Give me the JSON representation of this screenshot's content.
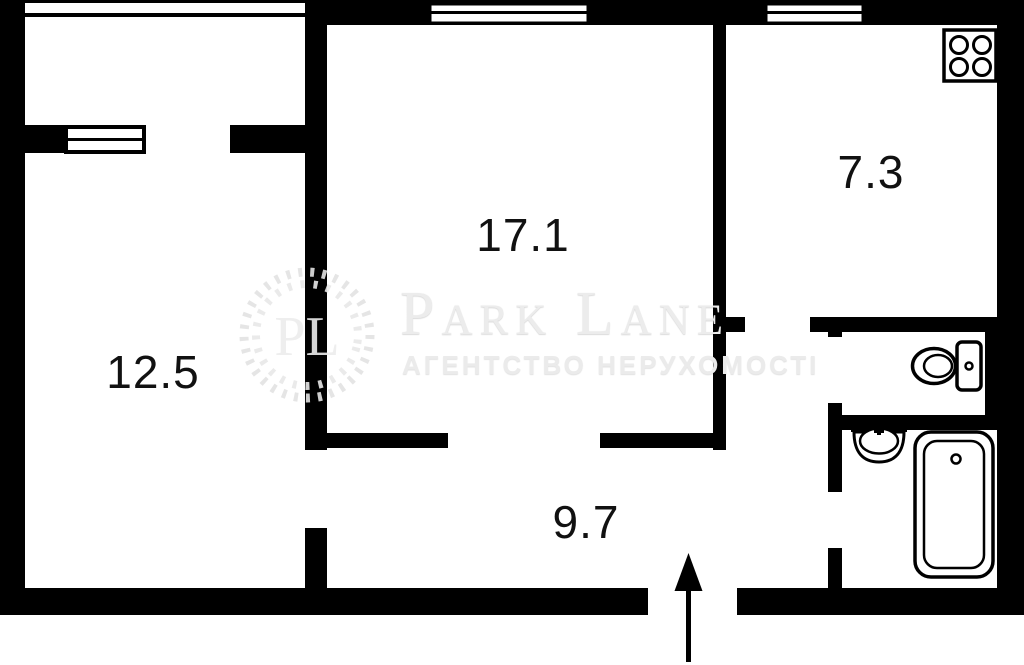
{
  "plan": {
    "rooms": [
      {
        "id": "living-room",
        "area": "12.5"
      },
      {
        "id": "bedroom",
        "area": "17.1"
      },
      {
        "id": "kitchen",
        "area": "7.3"
      },
      {
        "id": "hallway",
        "area": "9.7"
      }
    ],
    "fixtures": {
      "stove": "stove-icon",
      "toilet": "toilet-icon",
      "sink": "sink-icon",
      "bathtub": "bathtub-icon",
      "entrance": "entrance-arrow-icon",
      "windows": "window-icon"
    },
    "colors": {
      "wall": "#000000",
      "background": "#ffffff",
      "label": "#111111",
      "watermark": "#ececec"
    }
  },
  "watermark": {
    "monogram": "PL",
    "brand": "Park Lane",
    "tagline": "АГЕНТСТВО НЕРУХОМОСТІ"
  }
}
